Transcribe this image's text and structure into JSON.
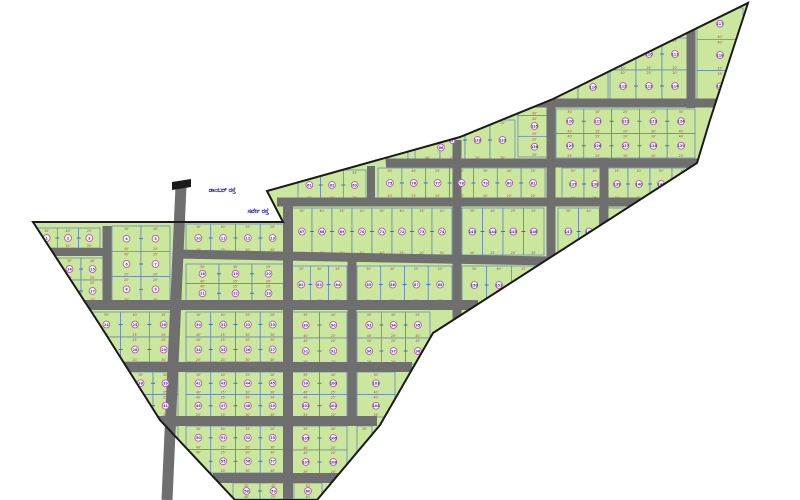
{
  "title": "Survey plot layout map",
  "canvas": {
    "width": 800,
    "height": 500,
    "background": "#ffffff"
  },
  "colors": {
    "plot_fill": "#cbe79d",
    "plot_border": "#5b7cbd",
    "road": "#6f6f6f",
    "boundary": "#1a1a1a",
    "circle_ring": "#c052a8",
    "circle_fill": "#ffffff",
    "number_text": "#31379b",
    "dim_text": "#a84a32",
    "tick": "#3b6fd4",
    "label_text": "#2a1fb8",
    "flag": "#1a1a1a"
  },
  "boundary": [
    [
      33,
      222
    ],
    [
      283,
      222
    ],
    [
      267,
      191
    ],
    [
      460,
      137
    ],
    [
      553,
      99
    ],
    [
      748,
      3
    ],
    [
      710,
      120
    ],
    [
      697,
      163
    ],
    [
      433,
      333
    ],
    [
      380,
      425
    ],
    [
      317,
      500
    ],
    [
      235,
      500
    ],
    [
      160,
      420
    ],
    [
      100,
      325
    ]
  ],
  "roads": [
    [
      181,
      186,
      167,
      500,
      11,
      0
    ],
    [
      107,
      226,
      107,
      306,
      9,
      1
    ],
    [
      288,
      203,
      288,
      500,
      10,
      1
    ],
    [
      352,
      256,
      352,
      426,
      9,
      1
    ],
    [
      457,
      140,
      457,
      342,
      9,
      1
    ],
    [
      551,
      101,
      551,
      262,
      9,
      1
    ],
    [
      604,
      158,
      604,
      236,
      9,
      1
    ],
    [
      691,
      25,
      691,
      108,
      9,
      1
    ],
    [
      371,
      166,
      371,
      206,
      8,
      1
    ],
    [
      534,
      103,
      716,
      103,
      9,
      1
    ],
    [
      386,
      163,
      700,
      163,
      9,
      1
    ],
    [
      277,
      202,
      640,
      202,
      9,
      1
    ],
    [
      44,
      252,
      104,
      252,
      8,
      1
    ],
    [
      174,
      254,
      551,
      261,
      9,
      1
    ],
    [
      80,
      305,
      478,
      305,
      10,
      1
    ],
    [
      122,
      367,
      412,
      367,
      10,
      1
    ],
    [
      155,
      421,
      377,
      421,
      10,
      1
    ],
    [
      213,
      478,
      338,
      478,
      10,
      1
    ]
  ],
  "blocks": [
    [
      36,
      228,
      64,
      20,
      3,
      1,
      1
    ],
    [
      112,
      226,
      58,
      76,
      2,
      3,
      1
    ],
    [
      186,
      224,
      99,
      28,
      4,
      1,
      1
    ],
    [
      58,
      258,
      46,
      44,
      2,
      2,
      1
    ],
    [
      186,
      264,
      99,
      39,
      3,
      2,
      1
    ],
    [
      92,
      312,
      86,
      50,
      3,
      2,
      1
    ],
    [
      186,
      312,
      99,
      50,
      4,
      2,
      1
    ],
    [
      128,
      372,
      50,
      45,
      2,
      2,
      1
    ],
    [
      186,
      372,
      99,
      45,
      4,
      2,
      1
    ],
    [
      162,
      426,
      16,
      47,
      1,
      2,
      0
    ],
    [
      186,
      426,
      99,
      47,
      4,
      2,
      1
    ],
    [
      233,
      483,
      54,
      16,
      2,
      1,
      1
    ],
    [
      294,
      483,
      28,
      16,
      1,
      1,
      1
    ],
    [
      298,
      170,
      68,
      30,
      3,
      1,
      1
    ],
    [
      386,
      132,
      66,
      31,
      3,
      1,
      1
    ],
    [
      292,
      208,
      160,
      47,
      8,
      1,
      1
    ],
    [
      378,
      168,
      167,
      30,
      7,
      1,
      1
    ],
    [
      292,
      266,
      55,
      37,
      3,
      1,
      1
    ],
    [
      357,
      266,
      95,
      37,
      4,
      1,
      1
    ],
    [
      292,
      312,
      55,
      52,
      2,
      2,
      1
    ],
    [
      357,
      312,
      73,
      52,
      3,
      2,
      1
    ],
    [
      292,
      372,
      55,
      45,
      2,
      2,
      1
    ],
    [
      357,
      372,
      38,
      45,
      1,
      2,
      1
    ],
    [
      292,
      426,
      55,
      48,
      2,
      2,
      1
    ],
    [
      357,
      426,
      15,
      30,
      1,
      1,
      0
    ],
    [
      610,
      38,
      78,
      64,
      3,
      2,
      1
    ],
    [
      548,
      72,
      60,
      30,
      2,
      1,
      1
    ],
    [
      697,
      8,
      46,
      94,
      1,
      3,
      1
    ],
    [
      556,
      109,
      139,
      49,
      5,
      2,
      1
    ],
    [
      415,
      120,
      100,
      40,
      4,
      1,
      1
    ],
    [
      518,
      95,
      33,
      62,
      1,
      3,
      1
    ],
    [
      562,
      168,
      132,
      32,
      6,
      1,
      1
    ],
    [
      462,
      208,
      82,
      47,
      4,
      1,
      1
    ],
    [
      558,
      208,
      62,
      47,
      3,
      1,
      1
    ],
    [
      604,
      208,
      34,
      28,
      1,
      1,
      0
    ],
    [
      462,
      266,
      74,
      38,
      3,
      1,
      1
    ]
  ],
  "dim_labels": [
    "30'",
    "40'",
    "25'",
    "20'"
  ],
  "number_start": 1,
  "flag_marker": [
    [
      172,
      182
    ],
    [
      191,
      179
    ],
    [
      191,
      187
    ],
    [
      172,
      190
    ]
  ],
  "labels": [
    {
      "text": "ಡಾಂಬರ್ ರಸ್ತೆ",
      "x": 222,
      "y": 192
    },
    {
      "text": "ಸರ್ವೇ ರಸ್ತೆ",
      "x": 258,
      "y": 213
    }
  ]
}
